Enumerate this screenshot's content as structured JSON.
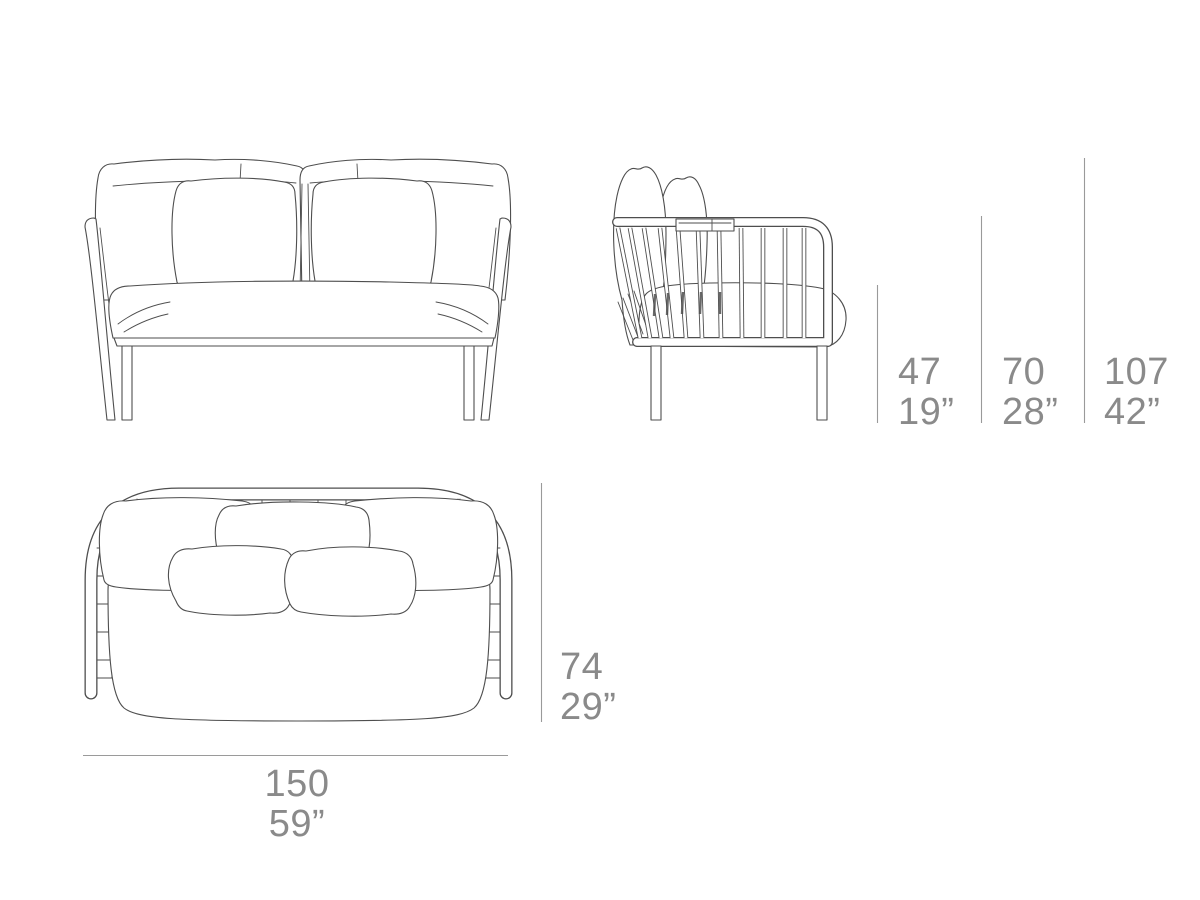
{
  "colors": {
    "bg": "#ffffff",
    "line": "#4e4e4e",
    "dim-line": "#9a9a9a",
    "dim-text": "#8a8a8a"
  },
  "dimensions": {
    "seat_height": {
      "cm": "47",
      "in": "19”"
    },
    "arm_height": {
      "cm": "70",
      "in": "28”"
    },
    "total_height": {
      "cm": "107",
      "in": "42”"
    },
    "depth": {
      "cm": "74",
      "in": "29”"
    },
    "width": {
      "cm": "150",
      "in": "59”"
    }
  }
}
